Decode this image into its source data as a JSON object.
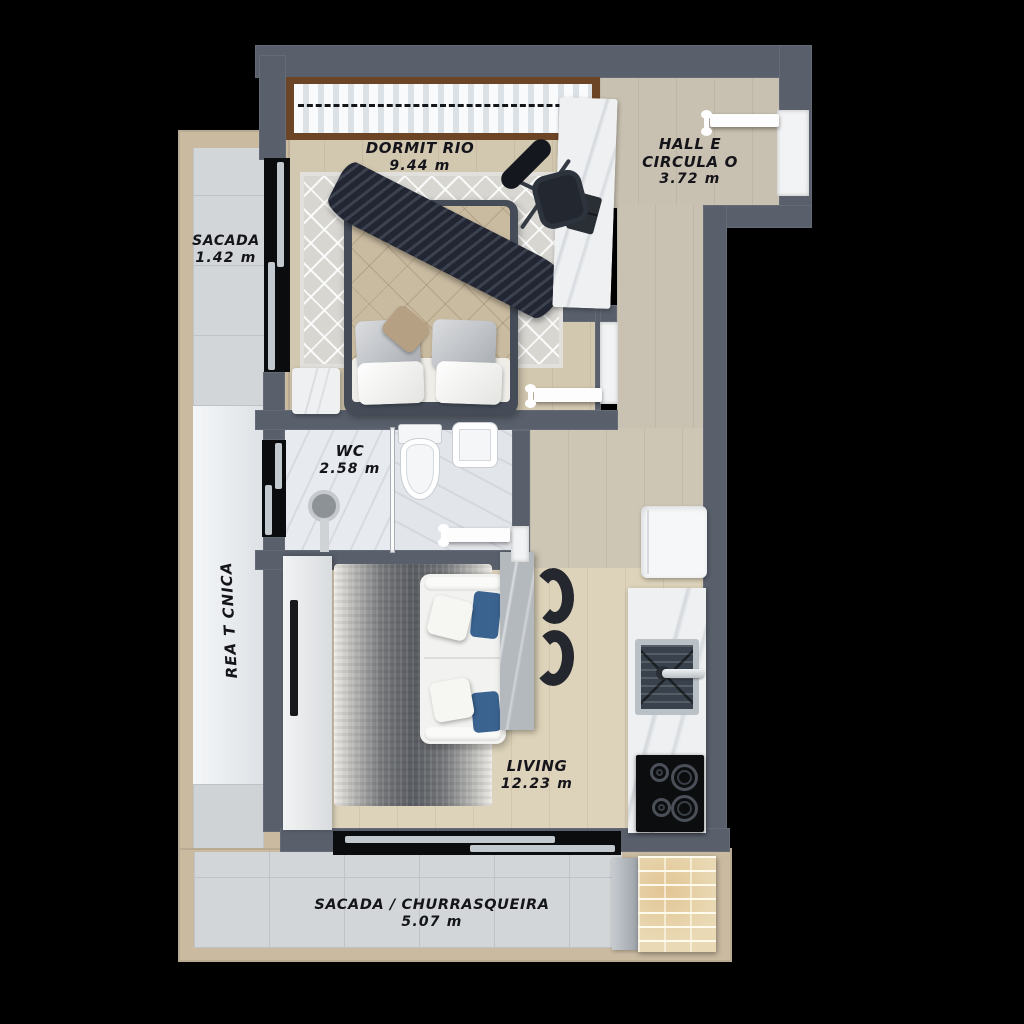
{
  "palette": {
    "background": "#000000",
    "wall": "#59606c",
    "wood_bedroom": "#d2c7af",
    "wood_hall": "#c8c1b1",
    "wood_living": "#ddd3ba",
    "balcony_tile": "#d3d6d8",
    "balcony_border": "#c9baa0",
    "marble_white": "#eef0f2",
    "marble_gray": "#b4b9be",
    "rug_dark": "#5a5d62",
    "sofa_accent_blue": "#3a6390",
    "brick": "#e9d9b4",
    "glass_black": "#0a0c0e"
  },
  "rooms": {
    "dormitorio": {
      "name": "DORMIT RIO",
      "area": "9.44 m"
    },
    "hall": {
      "name_line1": "HALL E",
      "name_line2": "CIRCULA O",
      "area": "3.72 m"
    },
    "sacada": {
      "name": "SACADA",
      "area": "1.42 m"
    },
    "wc": {
      "name": "WC",
      "area": "2.58 m"
    },
    "area_tecnica": {
      "name": "REA T CNICA"
    },
    "living": {
      "name": "LIVING",
      "area": "12.23 m"
    },
    "sacada_churrasqueira": {
      "name": "SACADA / CHURRASQUEIRA",
      "area": "5.07 m"
    }
  }
}
